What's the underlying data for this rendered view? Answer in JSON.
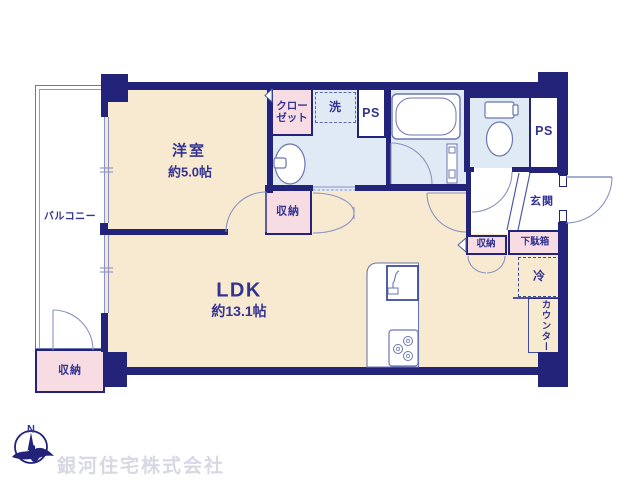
{
  "rooms": {
    "balcony": {
      "label": "バルコニー"
    },
    "western_room": {
      "label": "洋室",
      "size": "約5.0帖"
    },
    "ldk": {
      "label": "LDK",
      "size": "約13.1帖"
    },
    "entrance": {
      "label": "玄関"
    }
  },
  "features": {
    "closet": {
      "line1": "クロー",
      "line2": "ゼット"
    },
    "laundry": {
      "label": "洗"
    },
    "pipe_space_left": {
      "label": "PS"
    },
    "pipe_space_right": {
      "label": "PS"
    },
    "shoe_box": {
      "label": "下駄箱"
    },
    "storage_mid": {
      "label": "収納"
    },
    "storage_hall": {
      "label": "収納"
    },
    "storage_balcony": {
      "label": "収納"
    },
    "refrigerator": {
      "label": "冷"
    },
    "counter": {
      "label": "カウンター"
    }
  },
  "compass": {
    "north": "N"
  },
  "watermark": {
    "company": "銀河住宅株式会社"
  },
  "colors": {
    "wall": "#23237a",
    "floor": "#f8ead0",
    "storage_pink": "#f8dce4",
    "wet_area_blue": "#e0eaf4",
    "label_text": "#333392",
    "watermark_text": "#d7d8e4"
  }
}
